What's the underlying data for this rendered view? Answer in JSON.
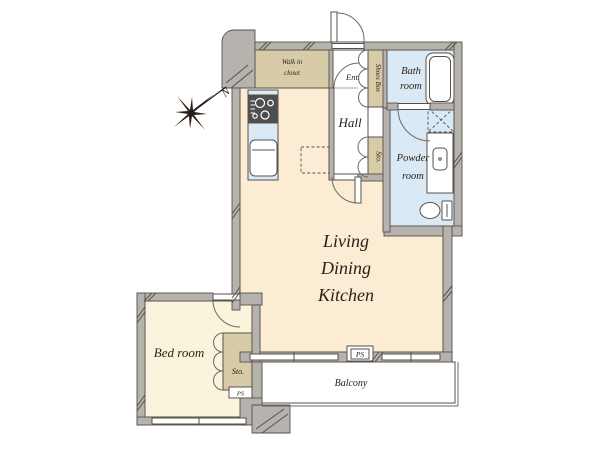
{
  "plan": {
    "compass": {
      "north_label": "N"
    },
    "rooms": {
      "walk_in_closet": {
        "line1": "Walk in",
        "line2": "closet"
      },
      "entrance": {
        "label": "Ent."
      },
      "shoes_box": {
        "label": "Shoes Box"
      },
      "bath_room": {
        "line1": "Bath",
        "line2": "room"
      },
      "hall": {
        "label": "Hall"
      },
      "hall_storage": {
        "label": "Sto."
      },
      "powder_room": {
        "line1": "Powder",
        "line2": "room"
      },
      "living_dining_kitchen": {
        "line1": "Living",
        "line2": "Dining",
        "line3": "Kitchen"
      },
      "bed_room": {
        "label": "Bed room"
      },
      "bedroom_storage": {
        "label": "Sto."
      },
      "balcony": {
        "label": "Balcony"
      }
    },
    "pipe_space": {
      "ldk_wall_label": "PS",
      "bedroom_label": "PS"
    },
    "colors": {
      "background": "#ffffff",
      "wall_fill": "#b6b2ae",
      "wall_outline": "#57514b",
      "ldk_floor": "#fcecd4",
      "bedroom_floor": "#f9f5dc",
      "closet_floor": "#d7cba8",
      "wet_area_floor": "#d9eaf6",
      "fixture_dark": "#4e4e4e",
      "label_text": "#2b2118"
    }
  }
}
